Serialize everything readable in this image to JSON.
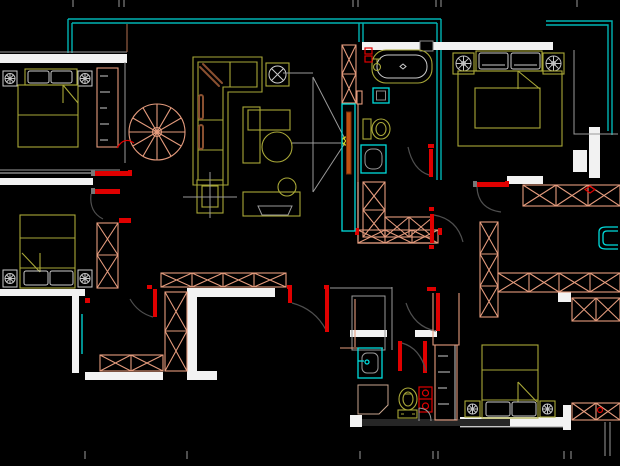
{
  "app": {
    "type": "cad-floor-plan-view",
    "view": "2d-apartment-plan"
  },
  "canvas": {
    "width": 620,
    "height": 466
  },
  "palette": {
    "background": "#000000",
    "window_wall_cyan": "#00b4b4",
    "glass_cyan": "#00dcdc",
    "wall_fill_white": "#f2f2f2",
    "wall_line_grey": "#9a9a9a",
    "light_grey": "#cbcbcb",
    "hatch_salmon": "#e49b7d",
    "hatch_salmon_light": "#f3b9a0",
    "furniture_olive": "#a9a838",
    "door_red": "#e00000",
    "accent_orange": "#c05010",
    "cushion_brown": "#8a5030",
    "marker_yellow": "#d6d21e",
    "dark_fill": "#262626",
    "hinge_grey": "#777777"
  },
  "entities": {
    "rooms": [
      "bedroom-top-left",
      "bedroom-left",
      "living-room",
      "bathroom-top",
      "bedroom-top-right",
      "utility-room-right",
      "hallway",
      "bathroom-bottom",
      "bedroom-bottom-right",
      "balcony-top"
    ],
    "furniture": [
      "double-bed",
      "nightstand-lamp",
      "corner-sofa",
      "coffee-table",
      "side-table",
      "tv-cabinet",
      "wardrobe"
    ],
    "fixtures": [
      "spiral-staircase",
      "bathtub",
      "toilet",
      "wash-basin",
      "shower",
      "floor-drain",
      "kitchen-sink",
      "ceiling-fixture"
    ],
    "openings": [
      "door-swing",
      "sliding-door",
      "window",
      "wall-hatch"
    ]
  }
}
